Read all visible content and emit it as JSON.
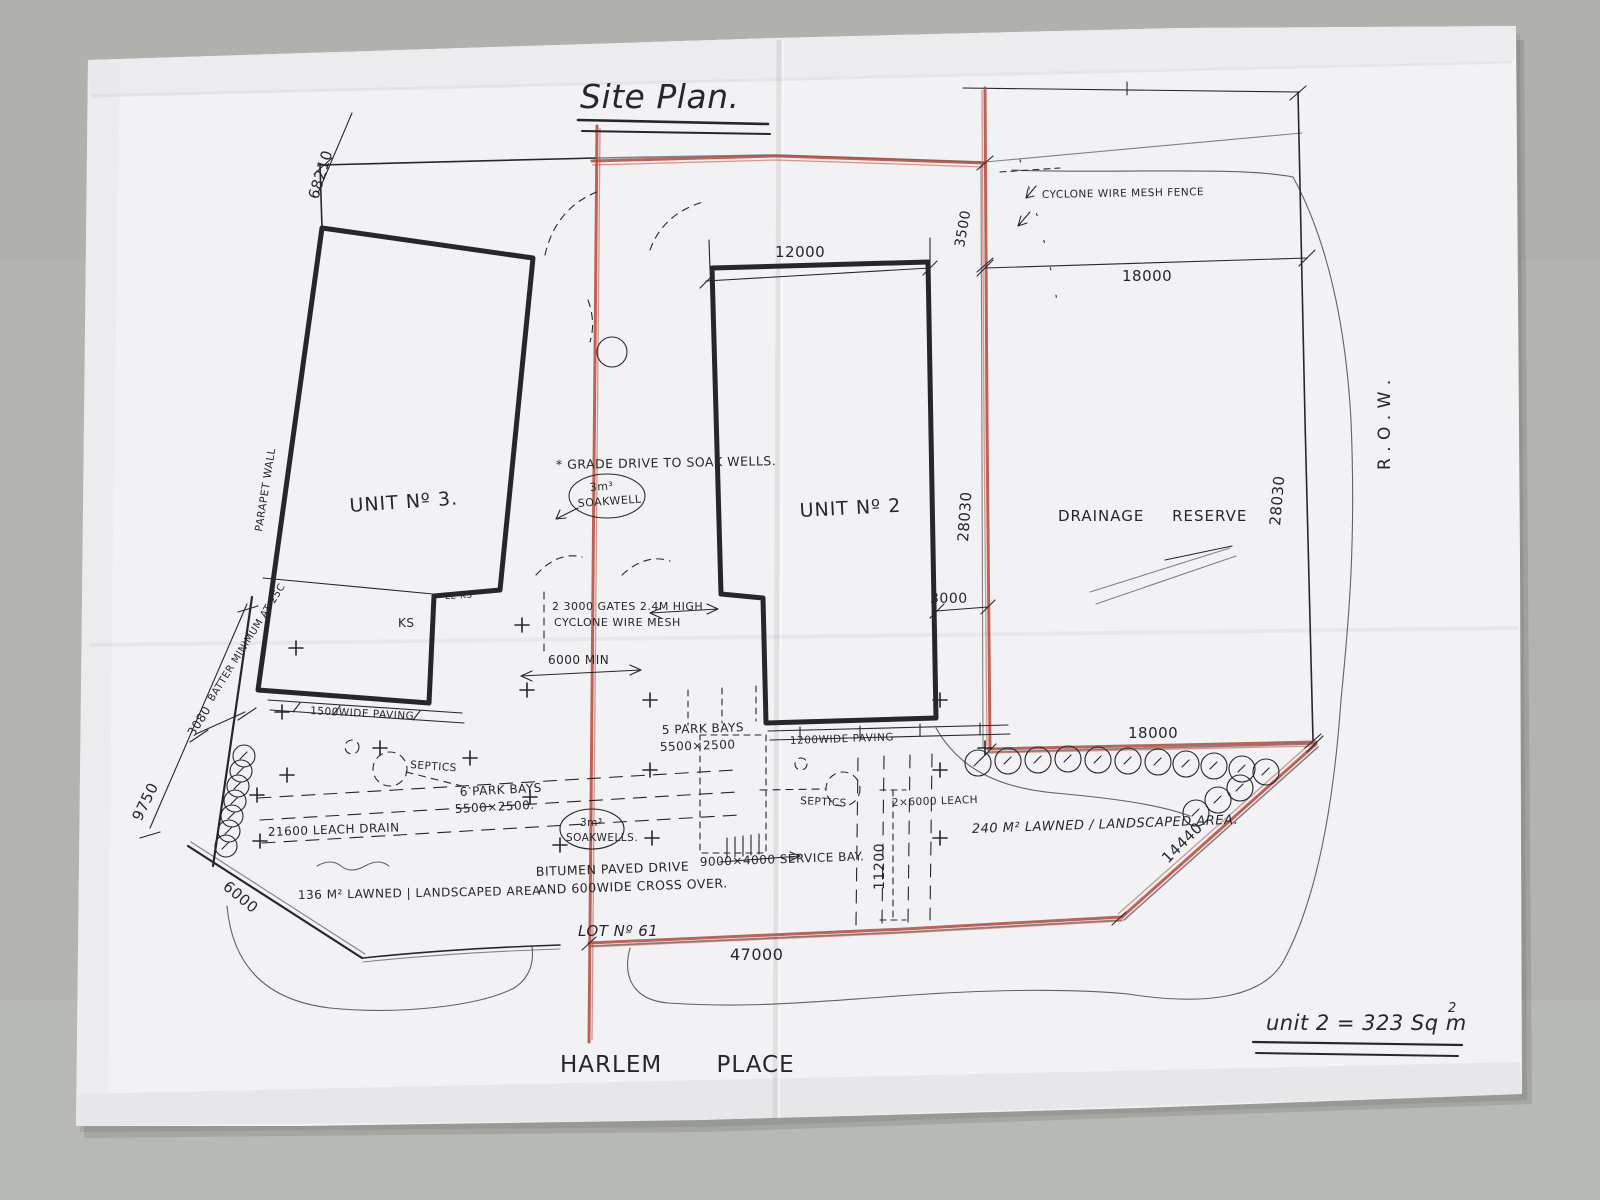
{
  "colors": {
    "background": "#b3b4b0",
    "paper": "#f2f2f4",
    "ink": "#26262c",
    "red_marker": "#b5493a"
  },
  "title": "Site Plan.",
  "labels": {
    "unit3": "UNIT Nº 3.",
    "unit2": "UNIT Nº 2",
    "drainage_reserve": "DRAINAGE RESERVE",
    "row": "R . O . W .",
    "lot": "LOT Nº 61",
    "street": "HARLEM PLACE",
    "area_note": "unit 2 = 323 Sq m",
    "area_note_sup": "2"
  },
  "dimensions": {
    "left_top": "68210",
    "unit2_width": "12000",
    "row_setback": "3500",
    "reserve_top": "18000",
    "boundary_red": "28030",
    "boundary_row": "28030",
    "unit2_side": "3000",
    "drive_min": "6000 MIN",
    "frontage": "47000",
    "reserve_bottom": "18000",
    "splay_right": "14440",
    "leach_len": "11200",
    "left_9750": "9750",
    "left_3080": "3080",
    "corner_splay": "6000"
  },
  "notes": {
    "fence": "CYCLONE WIRE MESH FENCE",
    "grade_drive": "* GRADE DRIVE TO SOAK WELLS.",
    "soakwell_top_1": "3m³",
    "soakwell_top_2": "SOAKWELL",
    "parapet": "PARAPET WALL",
    "batter": "BATTER MINIMUM AT 25C",
    "gates_1": "2 3000 GATES 2.4M HIGH",
    "gates_2": "CYCLONE WIRE MESH",
    "ks": "KS",
    "le_ks": "LE KS",
    "paving_left": "1500WIDE PAVING",
    "septics_left": "SEPTICS",
    "septics_right": "SEPTICS",
    "park_bays_5_1": "5 PARK BAYS",
    "park_bays_5_2": "5500×2500",
    "park_bays_6_1": "6 PARK BAYS",
    "park_bays_6_2": "5500×2500.",
    "leach_left": "21600 LEACH DRAIN",
    "soakwells_mid_1": "3m³",
    "soakwells_mid_2": "SOAKWELLS.",
    "drive_1": "BITUMEN PAVED DRIVE",
    "drive_2": "AND 600WIDE CROSS OVER.",
    "lawn_left": "136 M² LAWNED | LANDSCAPED AREA",
    "service_bay": "9000×4000 SERVICE BAY.",
    "paving_right": "1200WIDE PAVING",
    "leach_right": "2×6000 LEACH",
    "lawn_right": "240 M² LAWNED / LANDSCAPED AREA."
  }
}
